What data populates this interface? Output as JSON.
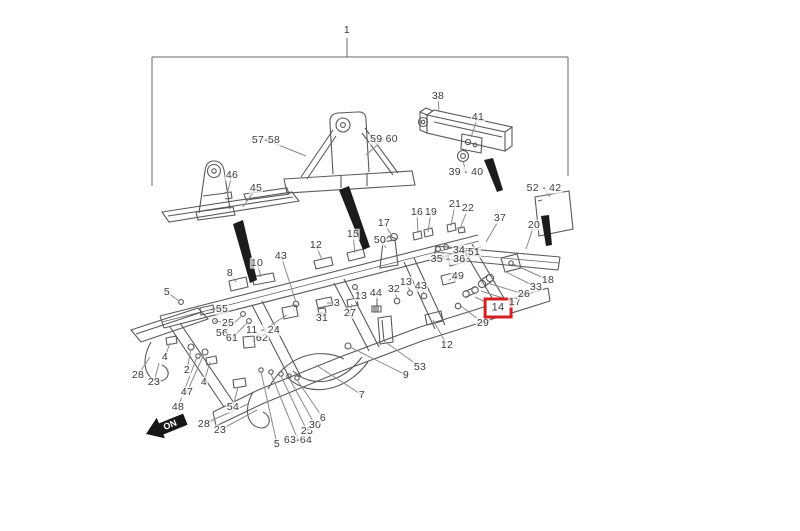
{
  "diagram": {
    "background": "#ffffff",
    "line_color": "#5a5a5a",
    "leader_color": "#8a8a8a",
    "label_color": "#3d3d3d",
    "highlight_color": "#d42020",
    "direction_arrow_label": "ON"
  },
  "callouts": [
    {
      "text": "1",
      "x": 347,
      "y": 30
    },
    {
      "text": "38",
      "x": 438,
      "y": 96,
      "lx": 439,
      "ly": 112
    },
    {
      "text": "41",
      "x": 478,
      "y": 117,
      "lx": 471,
      "ly": 137
    },
    {
      "text": "39 - 40",
      "x": 466,
      "y": 172,
      "lx": 463,
      "ly": 161
    },
    {
      "text": "57-58",
      "x": 266,
      "y": 140,
      "lx": 306,
      "ly": 156
    },
    {
      "text": "59 60",
      "x": 384,
      "y": 139,
      "lx": 366,
      "ly": 155
    },
    {
      "text": "52 - 42",
      "x": 544,
      "y": 188,
      "lx": 550,
      "ly": 197
    },
    {
      "text": "46",
      "x": 232,
      "y": 175,
      "lx": 227,
      "ly": 194
    },
    {
      "text": "45",
      "x": 256,
      "y": 188,
      "lx": 243,
      "ly": 207
    },
    {
      "text": "16",
      "x": 417,
      "y": 212,
      "lx": 418,
      "ly": 233
    },
    {
      "text": "19",
      "x": 431,
      "y": 212,
      "lx": 428,
      "ly": 232
    },
    {
      "text": "21",
      "x": 455,
      "y": 204,
      "lx": 451,
      "ly": 226
    },
    {
      "text": "22",
      "x": 468,
      "y": 208,
      "lx": 460,
      "ly": 229
    },
    {
      "text": "37",
      "x": 500,
      "y": 218,
      "lx": 486,
      "ly": 242
    },
    {
      "text": "20",
      "x": 534,
      "y": 225,
      "lx": 526,
      "ly": 249
    },
    {
      "text": "17",
      "x": 384,
      "y": 223,
      "lx": 392,
      "ly": 236
    },
    {
      "text": "15",
      "x": 353,
      "y": 234,
      "lx": 355,
      "ly": 253
    },
    {
      "text": "50",
      "x": 380,
      "y": 240,
      "lx": 386,
      "ly": 248
    },
    {
      "text": "12",
      "x": 316,
      "y": 245,
      "lx": 322,
      "ly": 260
    },
    {
      "text": "43",
      "x": 281,
      "y": 256,
      "lx": 296,
      "ly": 302
    },
    {
      "text": "10",
      "x": 257,
      "y": 263,
      "lx": 261,
      "ly": 277
    },
    {
      "text": "8",
      "x": 230,
      "y": 273,
      "lx": 236,
      "ly": 282
    },
    {
      "text": "34",
      "x": 459,
      "y": 250,
      "lx": 456,
      "ly": 257
    },
    {
      "text": "51",
      "x": 474,
      "y": 252,
      "lx": 466,
      "ly": 260
    },
    {
      "text": "35 - 36",
      "x": 448,
      "y": 259,
      "lx": 441,
      "ly": 252
    },
    {
      "text": "49",
      "x": 458,
      "y": 276,
      "lx": 449,
      "ly": 280
    },
    {
      "text": "13",
      "x": 406,
      "y": 282,
      "lx": 410,
      "ly": 291
    },
    {
      "text": "43",
      "x": 421,
      "y": 286,
      "lx": 424,
      "ly": 294
    },
    {
      "text": "32",
      "x": 394,
      "y": 289,
      "lx": 397,
      "ly": 299
    },
    {
      "text": "13",
      "x": 361,
      "y": 296,
      "lx": 356,
      "ly": 288
    },
    {
      "text": "44",
      "x": 376,
      "y": 293,
      "lx": 377,
      "ly": 303
    },
    {
      "text": "27",
      "x": 350,
      "y": 313,
      "lx": 352,
      "ly": 304
    },
    {
      "text": "3",
      "x": 337,
      "y": 303,
      "lx": 327,
      "ly": 303
    },
    {
      "text": "31",
      "x": 322,
      "y": 318,
      "lx": 321,
      "ly": 312
    },
    {
      "text": "55",
      "x": 222,
      "y": 309,
      "lx": 210,
      "ly": 310
    },
    {
      "text": "25",
      "x": 228,
      "y": 323,
      "lx": 215,
      "ly": 321
    },
    {
      "text": "56",
      "x": 222,
      "y": 333,
      "lx": 242,
      "ly": 316
    },
    {
      "text": "61",
      "x": 232,
      "y": 338,
      "lx": 248,
      "ly": 322
    },
    {
      "text": "62",
      "x": 262,
      "y": 338,
      "lx": 253,
      "ly": 341
    },
    {
      "text": "11 - 24",
      "x": 263,
      "y": 330,
      "lx": 287,
      "ly": 315
    },
    {
      "text": "5",
      "x": 167,
      "y": 292,
      "lx": 179,
      "ly": 301
    },
    {
      "text": "4",
      "x": 165,
      "y": 357,
      "lx": 170,
      "ly": 343
    },
    {
      "text": "2",
      "x": 187,
      "y": 370,
      "lx": 191,
      "ly": 349
    },
    {
      "text": "47",
      "x": 187,
      "y": 392,
      "lx": 204,
      "ly": 354
    },
    {
      "text": "48",
      "x": 178,
      "y": 407,
      "lx": 197,
      "ly": 357
    },
    {
      "text": "28",
      "x": 138,
      "y": 375,
      "lx": 150,
      "ly": 357
    },
    {
      "text": "23",
      "x": 154,
      "y": 382,
      "lx": 159,
      "ly": 363
    },
    {
      "text": "4",
      "x": 204,
      "y": 382,
      "lx": 210,
      "ly": 362
    },
    {
      "text": "28",
      "x": 204,
      "y": 424,
      "lx": 248,
      "ly": 404
    },
    {
      "text": "23",
      "x": 220,
      "y": 430,
      "lx": 257,
      "ly": 410
    },
    {
      "text": "54",
      "x": 233,
      "y": 407,
      "lx": 238,
      "ly": 387
    },
    {
      "text": "5",
      "x": 277,
      "y": 444,
      "lx": 261,
      "ly": 372
    },
    {
      "text": "63-64",
      "x": 298,
      "y": 440,
      "lx": 271,
      "ly": 374
    },
    {
      "text": "25",
      "x": 307,
      "y": 431,
      "lx": 281,
      "ly": 376
    },
    {
      "text": "30",
      "x": 315,
      "y": 425,
      "lx": 289,
      "ly": 378
    },
    {
      "text": "6",
      "x": 323,
      "y": 418,
      "lx": 297,
      "ly": 380
    },
    {
      "text": "7",
      "x": 362,
      "y": 395,
      "lx": 316,
      "ly": 365
    },
    {
      "text": "9",
      "x": 406,
      "y": 375,
      "lx": 350,
      "ly": 347
    },
    {
      "text": "53",
      "x": 420,
      "y": 367,
      "lx": 384,
      "ly": 341
    },
    {
      "text": "12",
      "x": 447,
      "y": 345,
      "lx": 433,
      "ly": 320
    },
    {
      "text": "29",
      "x": 483,
      "y": 323,
      "lx": 461,
      "ly": 306
    },
    {
      "text": "14",
      "x": 498,
      "y": 308,
      "lx": 475,
      "ly": 297,
      "highlighted": true
    },
    {
      "text": "17",
      "x": 515,
      "y": 302,
      "lx": 481,
      "ly": 291
    },
    {
      "text": "26",
      "x": 524,
      "y": 294,
      "lx": 487,
      "ly": 283
    },
    {
      "text": "33",
      "x": 536,
      "y": 287,
      "lx": 504,
      "ly": 271
    },
    {
      "text": "18",
      "x": 548,
      "y": 280,
      "lx": 513,
      "ly": 264
    }
  ]
}
